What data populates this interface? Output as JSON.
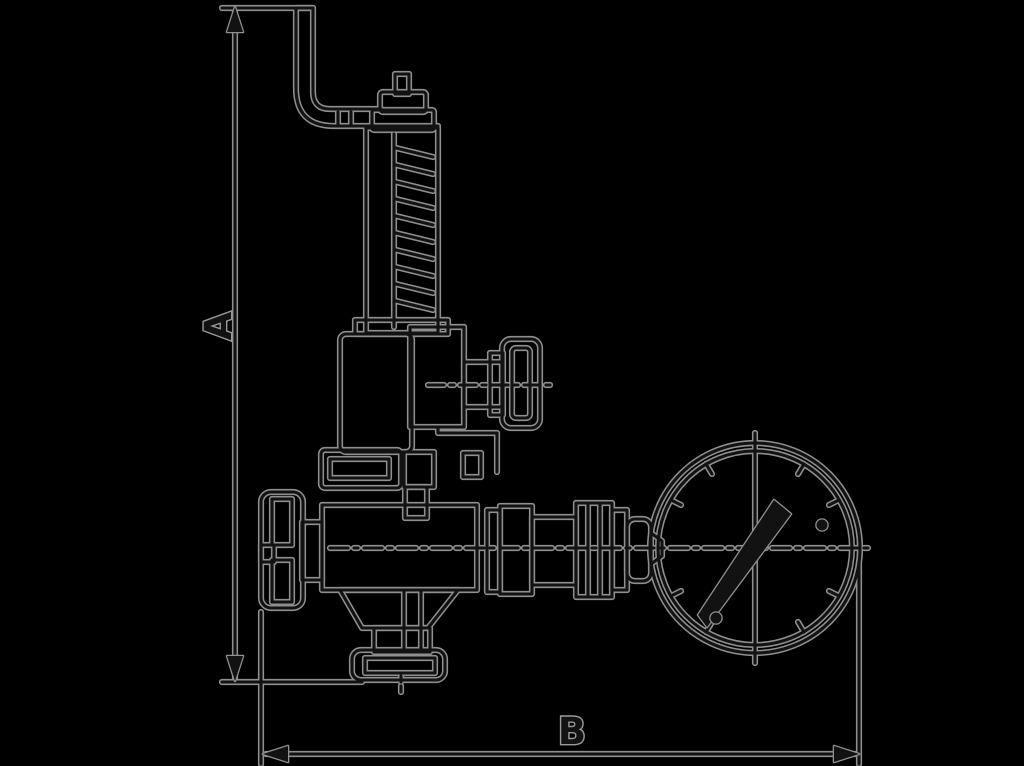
{
  "page": {
    "background_color": "#000000",
    "line_core_color": "#121212",
    "line_halo_color": "#8f8f8f"
  },
  "drawing": {
    "type": "technical-dimension-drawing",
    "subject": "relief-valve-with-pressure-gauge",
    "dimension_a_label": "A",
    "dimension_b_label": "B",
    "components": [
      "lever-arm",
      "spring-bonnet",
      "spring-coil",
      "side-tee-knob",
      "mid-flange",
      "handwheel",
      "valve-body",
      "bottom-outlet-flange",
      "pipe-union",
      "pressure-gauge",
      "gauge-needle"
    ]
  }
}
